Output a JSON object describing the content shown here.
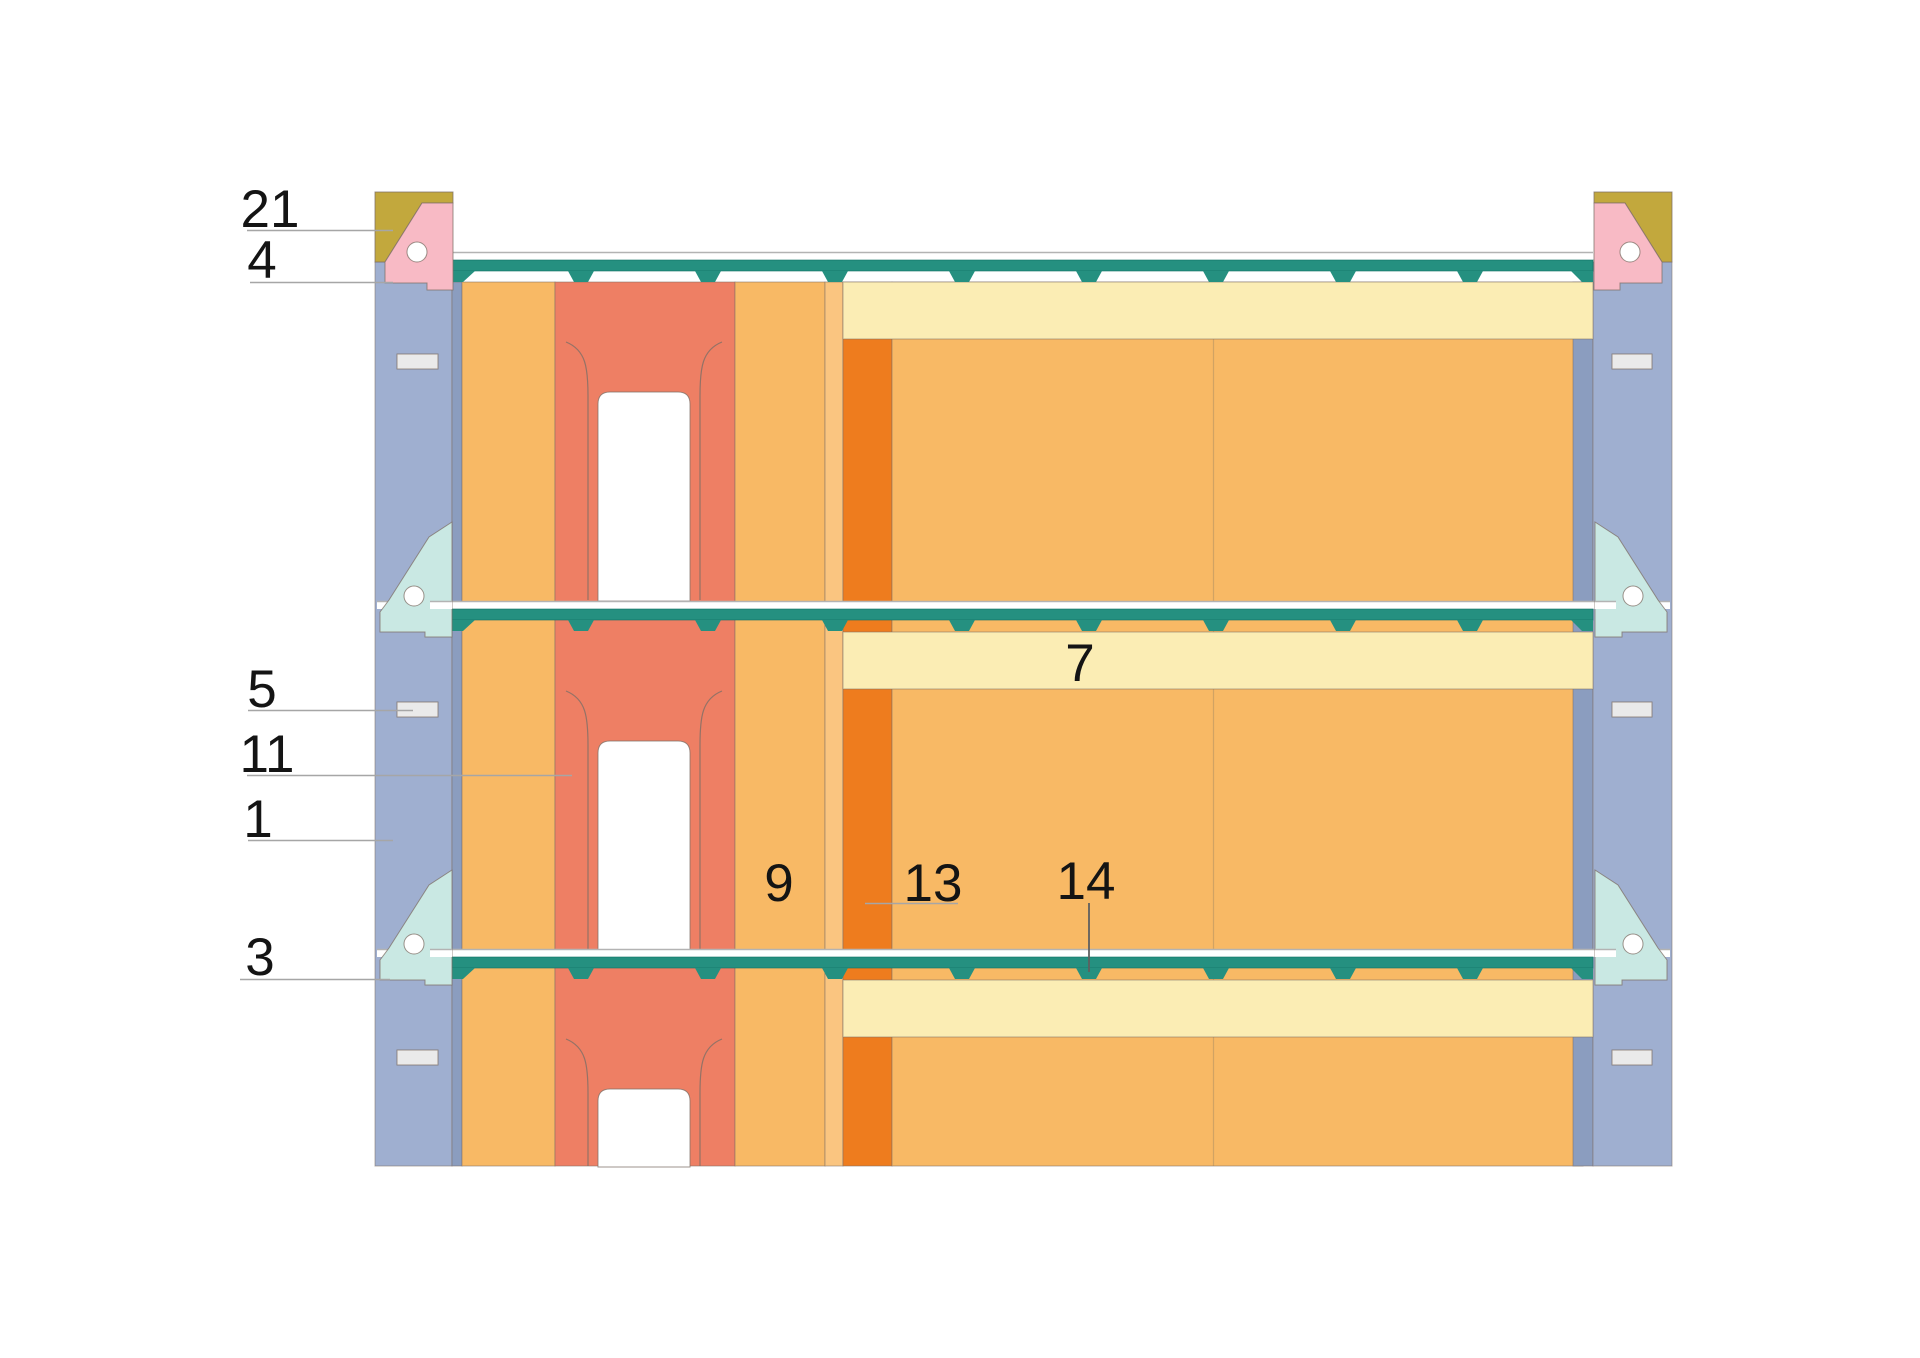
{
  "figure": {
    "type": "construction-detail-cross-section",
    "description_visible_text_only": true
  },
  "callouts": [
    {
      "number": "21"
    },
    {
      "number": "4"
    },
    {
      "number": "5"
    },
    {
      "number": "11"
    },
    {
      "number": "1"
    },
    {
      "number": "3"
    },
    {
      "number": "7"
    },
    {
      "number": "9"
    },
    {
      "number": "13"
    },
    {
      "number": "14"
    }
  ],
  "colors": {
    "insulation_blue": "#9FAFD0",
    "adhesive_blue": "#8B9DBF",
    "plaster_orange": "#F8B965",
    "orange_light": "#FAC580",
    "orange_deep": "#EE7C1E",
    "block_salmon": "#EE7F64",
    "board_yellow": "#FBEDB4",
    "plate_khaki": "#C2A83D",
    "connector_pink": "#F8BAC5",
    "profile_teal": "#259080",
    "bracket_cyan": "#C9E8E3",
    "plug_gray": "#EAEAEA",
    "line_gray": "#B3B3B3",
    "leader_gray": "#A6A6A6",
    "leader_dark": "#5F5F5F",
    "text": "#141414",
    "outline": "#7D6F66"
  }
}
